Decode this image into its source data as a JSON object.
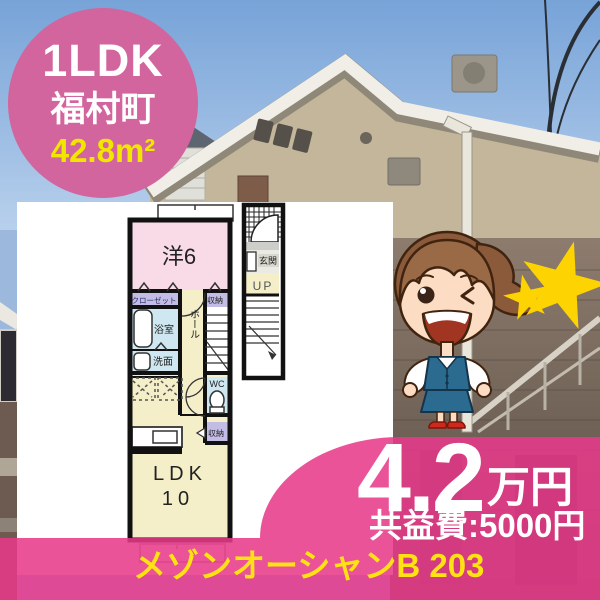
{
  "badge": {
    "layout_type": "1LDK",
    "town": "福村町",
    "floor_area": "42.8m²"
  },
  "price": {
    "amount": "4.2",
    "unit": "万円",
    "common_fee": "共益費:5000円"
  },
  "property_name": "メゾンオーシャンB 203",
  "floorplan": {
    "room_main": "洋6",
    "closet": "クローゼット",
    "storage_upper": "収納",
    "bath": "浴室",
    "washroom": "洗面",
    "hall": "ホール",
    "wc": "WC",
    "storage_lower": "収納",
    "ldk": "LDK",
    "ldk_size": "10",
    "entrance": "玄関",
    "stairs_up": "UP"
  },
  "colors": {
    "accent_pink": "#e83a8a",
    "badge_pink": "#d2659d",
    "highlight_yellow": "#ffe212",
    "star_yellow": "#fdd301",
    "room_pink": "#f8dbe7",
    "room_cream": "#f4eec9",
    "room_blue": "#cfe7f1",
    "room_purple": "#c3bce5"
  }
}
